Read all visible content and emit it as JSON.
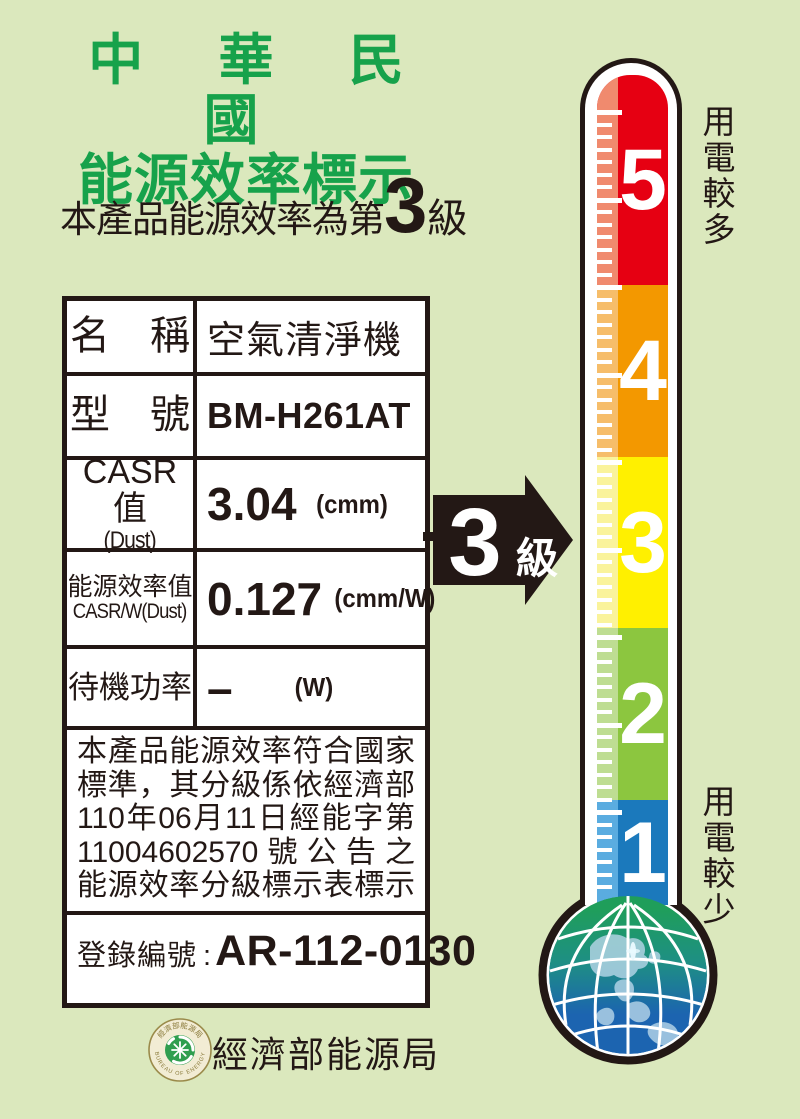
{
  "page": {
    "bg_color": "#dbe8bd",
    "ink_color": "#231815"
  },
  "header": {
    "title_line1": "中 華 民 國",
    "title_line2": "能源效率標示",
    "title_color": "#17a24b",
    "rating_prefix": "本產品能源效率為第",
    "rating_value": "3",
    "rating_suffix": "級"
  },
  "spec_table": {
    "rows": [
      {
        "label": "名　稱",
        "value": "空氣清淨機"
      },
      {
        "label": "型　號",
        "value": "BM-H261AT"
      },
      {
        "label": "CASR值",
        "sublabel": "(Dust)",
        "value": "3.04",
        "unit": "(cmm)"
      },
      {
        "label": "能源效率值",
        "sublabel": "CASR/W(Dust)",
        "value": "0.127",
        "unit": "(cmm/W)"
      },
      {
        "label": "待機功率",
        "value": "–",
        "unit": "(W)"
      }
    ],
    "statement_lines": [
      "本產品能源效率符合國家",
      "標準，其分級係依經濟部",
      "110年06月11日經能字第",
      "11004602570號公告之",
      "能源效率分級標示表標示"
    ],
    "registration_label": "登錄編號",
    "registration_separator": ":",
    "registration_value": "AR-112-0130"
  },
  "rating_arrow": {
    "value": "3",
    "suffix": "級",
    "color": "#231815",
    "text_color": "#ffffff"
  },
  "thermometer": {
    "top_label": "用電較多",
    "bottom_label": "用電較少",
    "number_color": "#ffffff",
    "tick_color": "#ffffff",
    "levels": [
      {
        "number": "5",
        "color": "#e60012",
        "strip_color": "#f08a6e"
      },
      {
        "number": "4",
        "color": "#f39800",
        "strip_color": "#f6bd6a"
      },
      {
        "number": "3",
        "color": "#fff000",
        "strip_color": "#faf39b"
      },
      {
        "number": "2",
        "color": "#8cc63f",
        "strip_color": "#bedd92"
      },
      {
        "number": "1",
        "color": "#1b79bc",
        "strip_color": "#5aace0"
      }
    ]
  },
  "globe": {
    "land_top_color": "#1f9e5a",
    "ocean_color": "#1c64b0",
    "shallow_land_color": "#b9d7ea",
    "grid_color": "#ffffff"
  },
  "footer": {
    "org_name": "經濟部能源局",
    "seal_top_text": "經濟部能源局",
    "seal_bottom_text": "BUREAU OF ENERGY",
    "seal_ring_color": "#9a8a4a",
    "seal_green": "#2f9e4f"
  }
}
